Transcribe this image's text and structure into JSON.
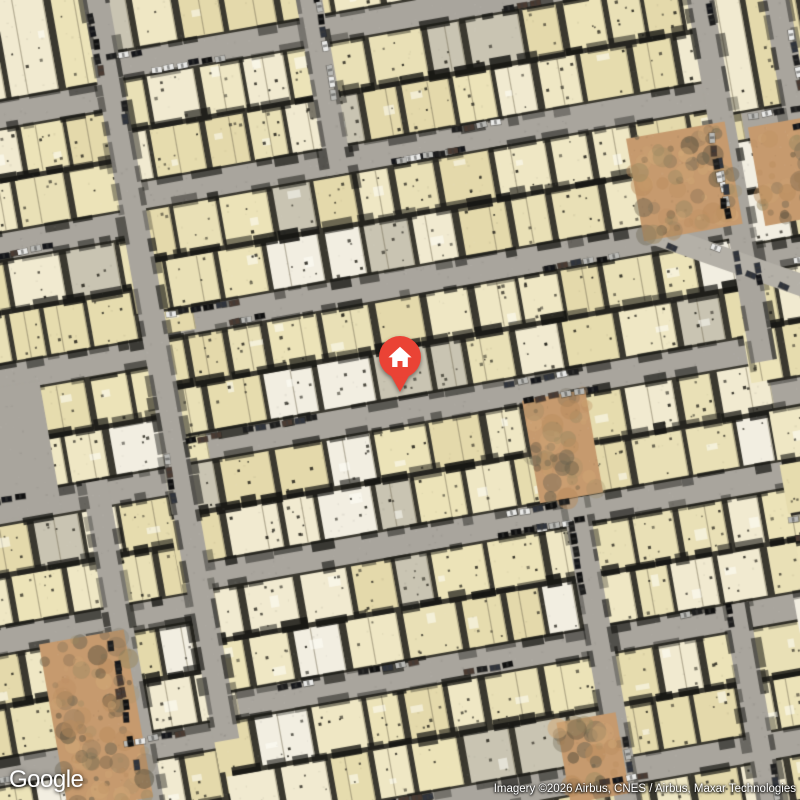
{
  "branding": {
    "logo_text": "Google"
  },
  "attribution": {
    "text": "Imagery ©2026 Airbus, CNES / Airbus, Maxar Technologies"
  },
  "marker": {
    "screen_x": 400,
    "screen_y": 357,
    "pin_color": "#EA4335",
    "icon": "house-icon",
    "icon_color": "#ffffff"
  },
  "map": {
    "type": "satellite",
    "rotation_deg": -10,
    "seed": 20260214,
    "frame": {
      "size": 1300,
      "center": 650
    },
    "street_half_width": 13,
    "palette": {
      "street": "#a9a59d",
      "street_light": "#b4b0a7",
      "block_underlay": "#3a382f",
      "house_colors": [
        "#ece3b8",
        "#efe7c4",
        "#e6dcae",
        "#f1ead0",
        "#e9e0b6",
        "#e4d9ab"
      ],
      "house_white": "#f2eee1",
      "house_gray": "#c9c4b2",
      "low_detail_fill": "#ddd4ad",
      "dirt_base": "#c69a6e",
      "dirt_mottle": [
        "#b98c5d",
        "#d2aa78",
        "#9c8a62",
        "#6b6350",
        "#58503e"
      ],
      "car_colors": [
        "#1e1e1e",
        "#15161a",
        "#101010",
        "#e9e9e7",
        "#b9b9b5",
        "#30343c",
        "#4a3b32"
      ]
    },
    "columns": [
      {
        "x0": 0,
        "x1": 420,
        "streets_y": [
          300,
          430,
          560,
          690,
          818,
          948,
          1078,
          1208
        ]
      },
      {
        "x0": 420,
        "x1": 1015,
        "streets_y": [
          272,
          404,
          535,
          662,
          790,
          922,
          1055,
          1188
        ]
      },
      {
        "x0": 1015,
        "x1": 1300,
        "streets_y": [
          440,
          572,
          710,
          845,
          980,
          1115
        ]
      }
    ],
    "v_streets": [
      {
        "x": 420,
        "y0": 160,
        "y1": 955
      },
      {
        "x": 630,
        "y0": 140,
        "y1": 417
      },
      {
        "x": 1015,
        "y0": 270,
        "y1": 675
      },
      {
        "x": 1090,
        "y0": 260,
        "y1": 453
      },
      {
        "x": 805,
        "y0": 777,
        "y1": 1215
      },
      {
        "x": 335,
        "y0": 677,
        "y1": 1215
      },
      {
        "x": 945,
        "y0": 909,
        "y1": 1215
      }
    ],
    "diagonal_streets": [
      {
        "x0": 925,
        "y0": 528,
        "x1": 1075,
        "y1": 612,
        "width": 22
      }
    ],
    "open_areas": [
      {
        "x": 180,
        "y": 568,
        "w": 118,
        "h": 132
      }
    ],
    "dirt_patches": [
      {
        "x": 918,
        "y": 432,
        "w": 100,
        "h": 104
      },
      {
        "x": 1040,
        "y": 442,
        "w": 85,
        "h": 100
      },
      {
        "x": 770,
        "y": 672,
        "w": 64,
        "h": 104
      },
      {
        "x": 252,
        "y": 828,
        "w": 86,
        "h": 170
      },
      {
        "x": 748,
        "y": 995,
        "w": 60,
        "h": 82
      }
    ]
  }
}
